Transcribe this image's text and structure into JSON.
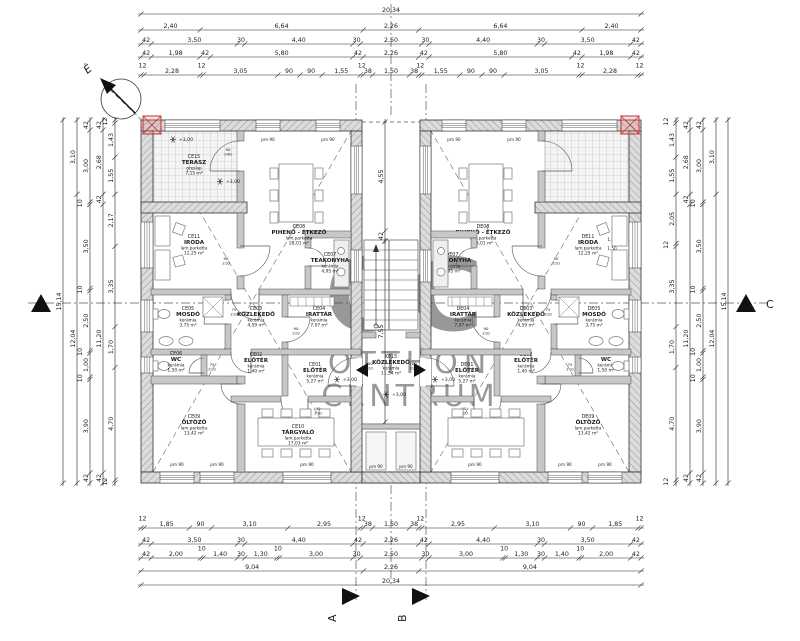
{
  "north": {
    "label": "É"
  },
  "watermark": {
    "monogram": "OC",
    "line1": "OTTHON",
    "line2": "CENTRUM"
  },
  "markers": {
    "a": "A",
    "b": "B",
    "c": "C"
  },
  "annotations": {
    "level_label": "+3,00",
    "sill_label": "pm 90",
    "window_size": [
      "1,20",
      "1,50"
    ],
    "door_sizes": {
      "terrace": "90/240",
      "office": "90/210",
      "washroom": "75/210",
      "wc": "75/210",
      "archive": "90/210",
      "meeting": "90/210",
      "entrance": "100/210"
    }
  },
  "core_room": {
    "code": "KE15",
    "name": "KÖZLEKEDŐ",
    "material": "kerámia",
    "area": "11,54 m²"
  },
  "units": {
    "left": {
      "rooms": [
        {
          "code": "CE15",
          "name": "TERASZ",
          "material": "greslap",
          "area": "7,15 m²"
        },
        {
          "code": "CE11",
          "name": "IRODA",
          "material": "lam.parketta",
          "area": "12,25 m²"
        },
        {
          "code": "CE08",
          "name": "PIHENŐ - ÉTKEZŐ",
          "material": "lam.parketta",
          "area": "28,01 m²"
        },
        {
          "code": "CE07",
          "name": "TEAKONYHA",
          "material": "kerámia",
          "area": "4,95 m²"
        },
        {
          "code": "CE05",
          "name": "MOSDÓ",
          "material": "kerámia",
          "area": "3,75 m²"
        },
        {
          "code": "CE03",
          "name": "KÖZLEKEDŐ",
          "material": "kerámia",
          "area": "4,59 m²"
        },
        {
          "code": "CE04",
          "name": "IRATTÁR",
          "material": "kerámia",
          "area": "7,07 m²"
        },
        {
          "code": "CE06",
          "name": "WC",
          "material": "kerámia",
          "area": "1,50 m²"
        },
        {
          "code": "CE02",
          "name": "ELŐTÉR",
          "material": "kerámia",
          "area": "1,40 m²"
        },
        {
          "code": "CE01",
          "name": "ELŐTÉR",
          "material": "kerámia",
          "area": "5,27 m²"
        },
        {
          "code": "CE09",
          "name": "ÖLTÖZŐ",
          "material": "lam.parketta",
          "area": "13,42 m²"
        },
        {
          "code": "CE10",
          "name": "TÁRGYALÓ",
          "material": "lam.parketta",
          "area": "17,03 m²"
        }
      ]
    },
    "right": {
      "rooms": [
        {
          "code": "DE15",
          "name": "TERASZ",
          "material": "greslap",
          "area": "7,15 m²"
        },
        {
          "code": "DE11",
          "name": "IRODA",
          "material": "lam.parketta",
          "area": "12,25 m²"
        },
        {
          "code": "DE08",
          "name": "PIHENŐ - ÉTKEZŐ",
          "material": "lam.parketta",
          "area": "28,01 m²"
        },
        {
          "code": "DE07",
          "name": "TEAKONYHA",
          "material": "kerámia",
          "area": "4,95 m²"
        },
        {
          "code": "DE05",
          "name": "MOSDÓ",
          "material": "kerámia",
          "area": "3,75 m²"
        },
        {
          "code": "DE03",
          "name": "KÖZLEKEDŐ",
          "material": "kerámia",
          "area": "4,59 m²"
        },
        {
          "code": "DE04",
          "name": "IRATTÁR",
          "material": "kerámia",
          "area": "7,07 m²"
        },
        {
          "code": "DE06",
          "name": "WC",
          "material": "kerámia",
          "area": "1,50 m²"
        },
        {
          "code": "DE02",
          "name": "ELŐTÉR",
          "material": "kerámia",
          "area": "1,40 m²"
        },
        {
          "code": "DE01",
          "name": "ELŐTÉR",
          "material": "kerámia",
          "area": "5,27 m²"
        },
        {
          "code": "DE09",
          "name": "ÖLTÖZŐ",
          "material": "lam.parketta",
          "area": "13,42 m²"
        },
        {
          "code": "DE10",
          "name": "TÁRGYALÓ",
          "material": "lam.parketta",
          "area": "17,03 m²"
        }
      ]
    }
  },
  "dimensions": {
    "top": [
      [
        "20,34"
      ],
      [
        "2,40",
        "6,64",
        "2,26",
        "6,64",
        "2,40"
      ],
      [
        "42",
        "3,50",
        "30",
        "4,40",
        "30",
        "2,50",
        "30",
        "4,40",
        "30",
        "3,50",
        "42"
      ],
      [
        "42",
        "1,98",
        "42",
        "5,80",
        "42",
        "2,26",
        "42",
        "5,80",
        "42",
        "1,98",
        "42"
      ],
      [
        "12",
        "2,28",
        "12",
        "3,05",
        "90",
        "90",
        "1,55",
        "12",
        "38",
        "1,50",
        "38",
        "12",
        "1,55",
        "90",
        "90",
        "3,05",
        "12",
        "2,28",
        "12"
      ]
    ],
    "bottom": [
      [
        "12",
        "1,85",
        "90",
        "3,10",
        "2,95",
        "12",
        "38",
        "1,50",
        "38",
        "12",
        "2,95",
        "3,10",
        "90",
        "1,85",
        "12"
      ],
      [
        "42",
        "3,50",
        "30",
        "4,40",
        "42",
        "2,26",
        "42",
        "4,40",
        "30",
        "3,50",
        "42"
      ],
      [
        "42",
        "2,00",
        "10",
        "1,40",
        "30",
        "1,30",
        "10",
        "3,00",
        "30",
        "2,50",
        "30",
        "3,00",
        "10",
        "1,30",
        "30",
        "1,40",
        "10",
        "2,00",
        "42"
      ],
      [
        "9,04",
        "2,26",
        "9,04"
      ],
      [
        "20,34"
      ]
    ],
    "left": [
      [
        "15,14"
      ],
      [
        "3,10",
        "12,04"
      ],
      [
        "42",
        "3,00",
        "10",
        "3,50",
        "10",
        "2,50",
        "10",
        "1,00",
        "10",
        "3,90",
        "42"
      ],
      [
        "42",
        "2,68",
        "42",
        "11,20",
        "42"
      ],
      [
        "12",
        "1,43",
        "1,55",
        "2,17",
        "3,35",
        "1,70",
        "4,70",
        "12"
      ]
    ],
    "right": [
      [
        "12",
        "1,43",
        "1,55",
        "2,05",
        "12",
        "3,35",
        "1,70",
        "4,70",
        "12"
      ],
      [
        "42",
        "2,68",
        "42",
        "11,20",
        "42"
      ],
      [
        "42",
        "3,00",
        "10",
        "3,50",
        "10",
        "2,50",
        "10",
        "1,00",
        "10",
        "3,90",
        "42"
      ],
      [
        "3,10",
        "12,04"
      ],
      [
        "15,14"
      ]
    ],
    "interior": [
      [
        "4,55",
        "42"
      ],
      [
        "7,55"
      ]
    ]
  }
}
